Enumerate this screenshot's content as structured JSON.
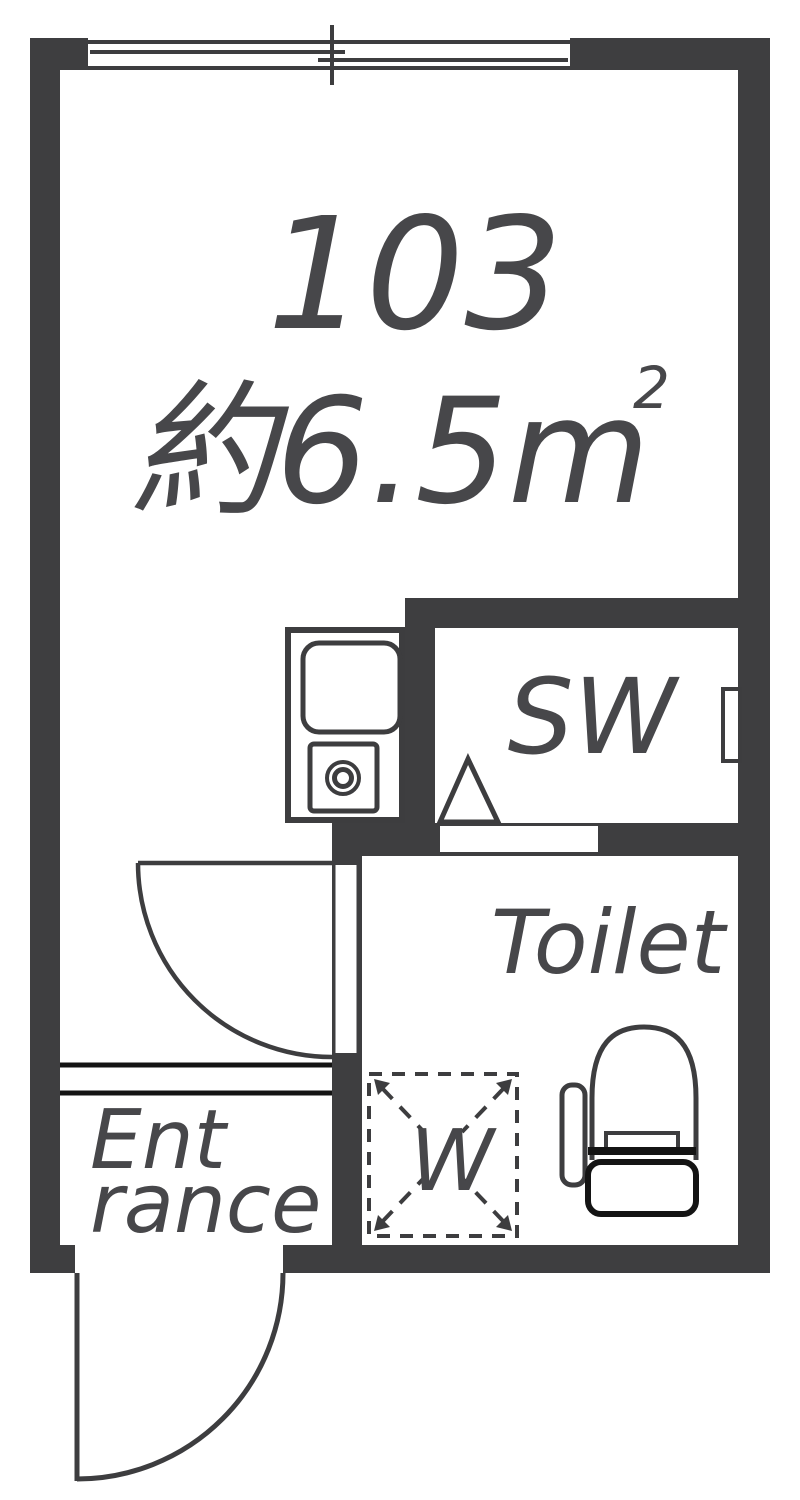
{
  "floor_plan": {
    "unit": {
      "number": "103",
      "area_label": "約6.5m",
      "area_superscript": "2"
    },
    "rooms": {
      "sw_closet": {
        "label": "SW"
      },
      "toilet": {
        "label": "Toilet"
      },
      "entrance": {
        "label_line1": "Ent",
        "label_line2": "rance"
      }
    },
    "fixtures": {
      "washing_machine": {
        "label": "W"
      }
    },
    "colors": {
      "wall": "#3e3e40",
      "line": "#3d3d3f",
      "text": "#47474a",
      "accent_black": "#141414",
      "background": "#ffffff"
    }
  }
}
